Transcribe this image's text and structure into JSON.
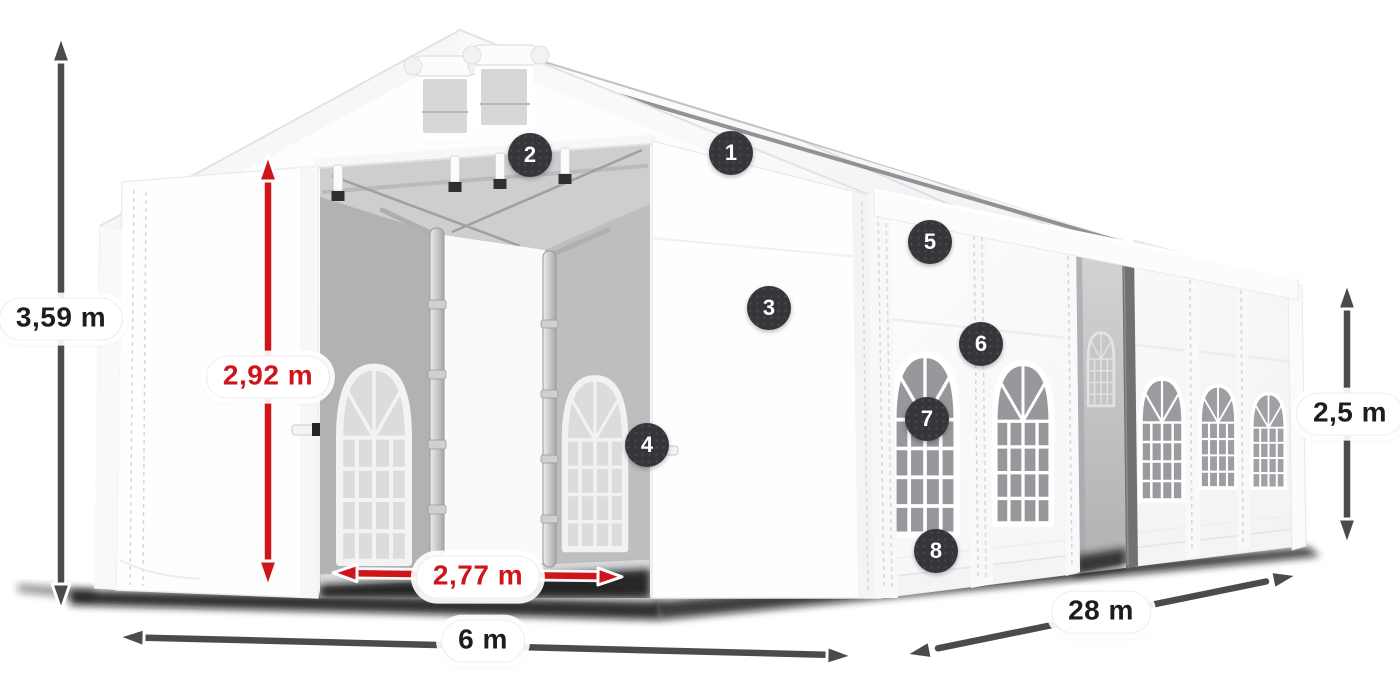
{
  "colors": {
    "background": "#ffffff",
    "dimension_dark": "#4a4b4d",
    "dimension_red": "#d0151a",
    "label_dark_text": "#1d1d1f",
    "marker_background": "#343639",
    "marker_text": "#ffffff",
    "tent_fabric": "#fdfdfe",
    "interior_gray": "#b3b4b6",
    "window_pane": "#97989b"
  },
  "dimensions": [
    {
      "id": "total-height",
      "label": "3,59 m",
      "accent": "dark",
      "orientation": "vertical"
    },
    {
      "id": "entrance-height",
      "label": "2,92 m",
      "accent": "red",
      "orientation": "vertical"
    },
    {
      "id": "entrance-width",
      "label": "2,77 m",
      "accent": "red",
      "orientation": "horizontal"
    },
    {
      "id": "width",
      "label": "6 m",
      "accent": "dark",
      "orientation": "horizontal"
    },
    {
      "id": "length",
      "label": "28 m",
      "accent": "dark",
      "orientation": "diagonal"
    },
    {
      "id": "side-height",
      "label": "2,5 m",
      "accent": "dark",
      "orientation": "vertical"
    }
  ],
  "markers": [
    {
      "label": "1"
    },
    {
      "label": "2"
    },
    {
      "label": "3"
    },
    {
      "label": "4"
    },
    {
      "label": "5"
    },
    {
      "label": "6"
    },
    {
      "label": "7"
    },
    {
      "label": "8"
    }
  ]
}
